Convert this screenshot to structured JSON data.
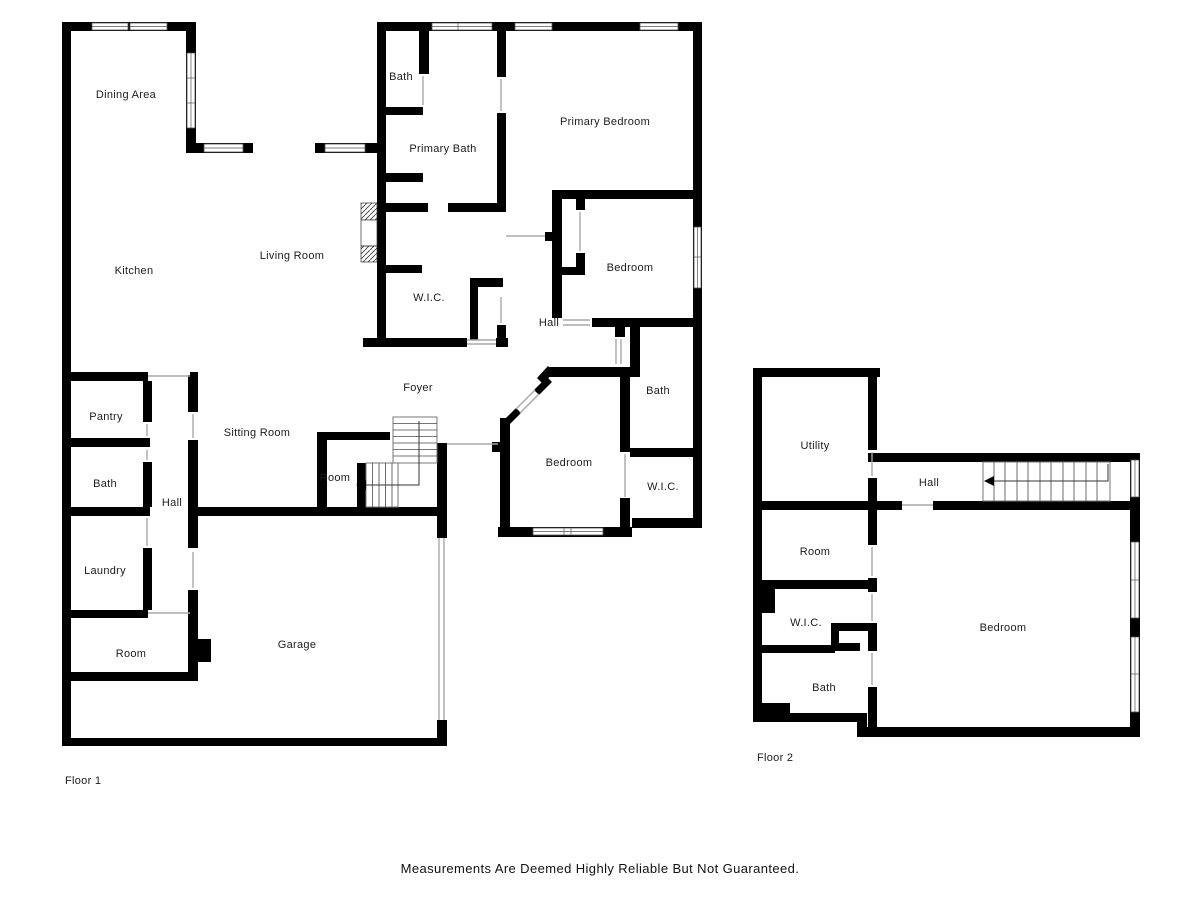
{
  "floor1": {
    "label": "Floor 1",
    "rooms": {
      "dining_area": "Dining Area",
      "bath_top": "Bath",
      "primary_bath": "Primary Bath",
      "primary_bedroom": "Primary Bedroom",
      "kitchen": "Kitchen",
      "living_room": "Living Room",
      "wic_primary": "W.I.C.",
      "hall_upper": "Hall",
      "bedroom_upper": "Bedroom",
      "bath_right": "Bath",
      "foyer": "Foyer",
      "sitting_room": "Sitting Room",
      "pantry": "Pantry",
      "bath_left": "Bath",
      "hall_left": "Hall",
      "room_stairs": "Room",
      "bedroom_center": "Bedroom",
      "wic_right": "W.I.C.",
      "laundry": "Laundry",
      "room_lower": "Room",
      "garage": "Garage"
    }
  },
  "floor2": {
    "label": "Floor 2",
    "rooms": {
      "utility": "Utility",
      "hall": "Hall",
      "room": "Room",
      "wic": "W.I.C.",
      "bedroom": "Bedroom",
      "bath": "Bath"
    }
  },
  "footer": {
    "disclaimer": "Measurements Are Deemed Highly Reliable But Not Guaranteed."
  },
  "colors": {
    "wall": "#000000",
    "background": "#ffffff",
    "door_line": "#a8a8a8",
    "text": "#1c1c1c"
  }
}
